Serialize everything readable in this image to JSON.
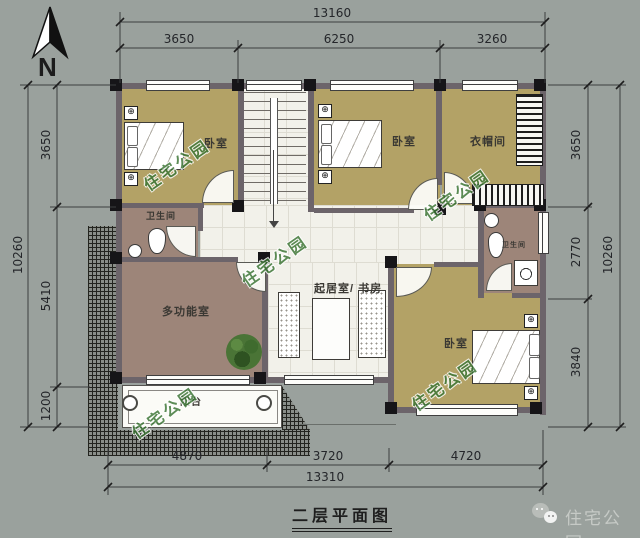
{
  "title": "二层平面图",
  "compass": {
    "label": "N"
  },
  "watermark_text": "住宅公园",
  "brand": {
    "name": "住宅公园"
  },
  "rooms": {
    "bedroom_nw": "卧室",
    "bedroom_n": "卧室",
    "cloakroom": "衣帽间",
    "bathroom_w": "卫生间",
    "bathroom_e": "卫生间",
    "multi_function": "多功能室",
    "living_study": "起居室/ 书房",
    "bedroom_se": "卧室",
    "balcony": "阳台"
  },
  "dimensions": {
    "top": {
      "total": "13160",
      "segments": [
        "3650",
        "6250",
        "3260"
      ]
    },
    "bottom": {
      "total": "13310",
      "segments": [
        "4870",
        "3720",
        "4720"
      ]
    },
    "left": {
      "total": "10260",
      "segments": [
        "3650",
        "5410",
        "1200"
      ]
    },
    "right": {
      "total": "10260",
      "segments": [
        "3650",
        "2770",
        "3840"
      ]
    }
  },
  "colors": {
    "background": "#9aa19d",
    "floor_tan": "#b3a266",
    "floor_brown": "#9d8579",
    "wall": "#6c646a",
    "watermark_green": "#3a7433"
  }
}
